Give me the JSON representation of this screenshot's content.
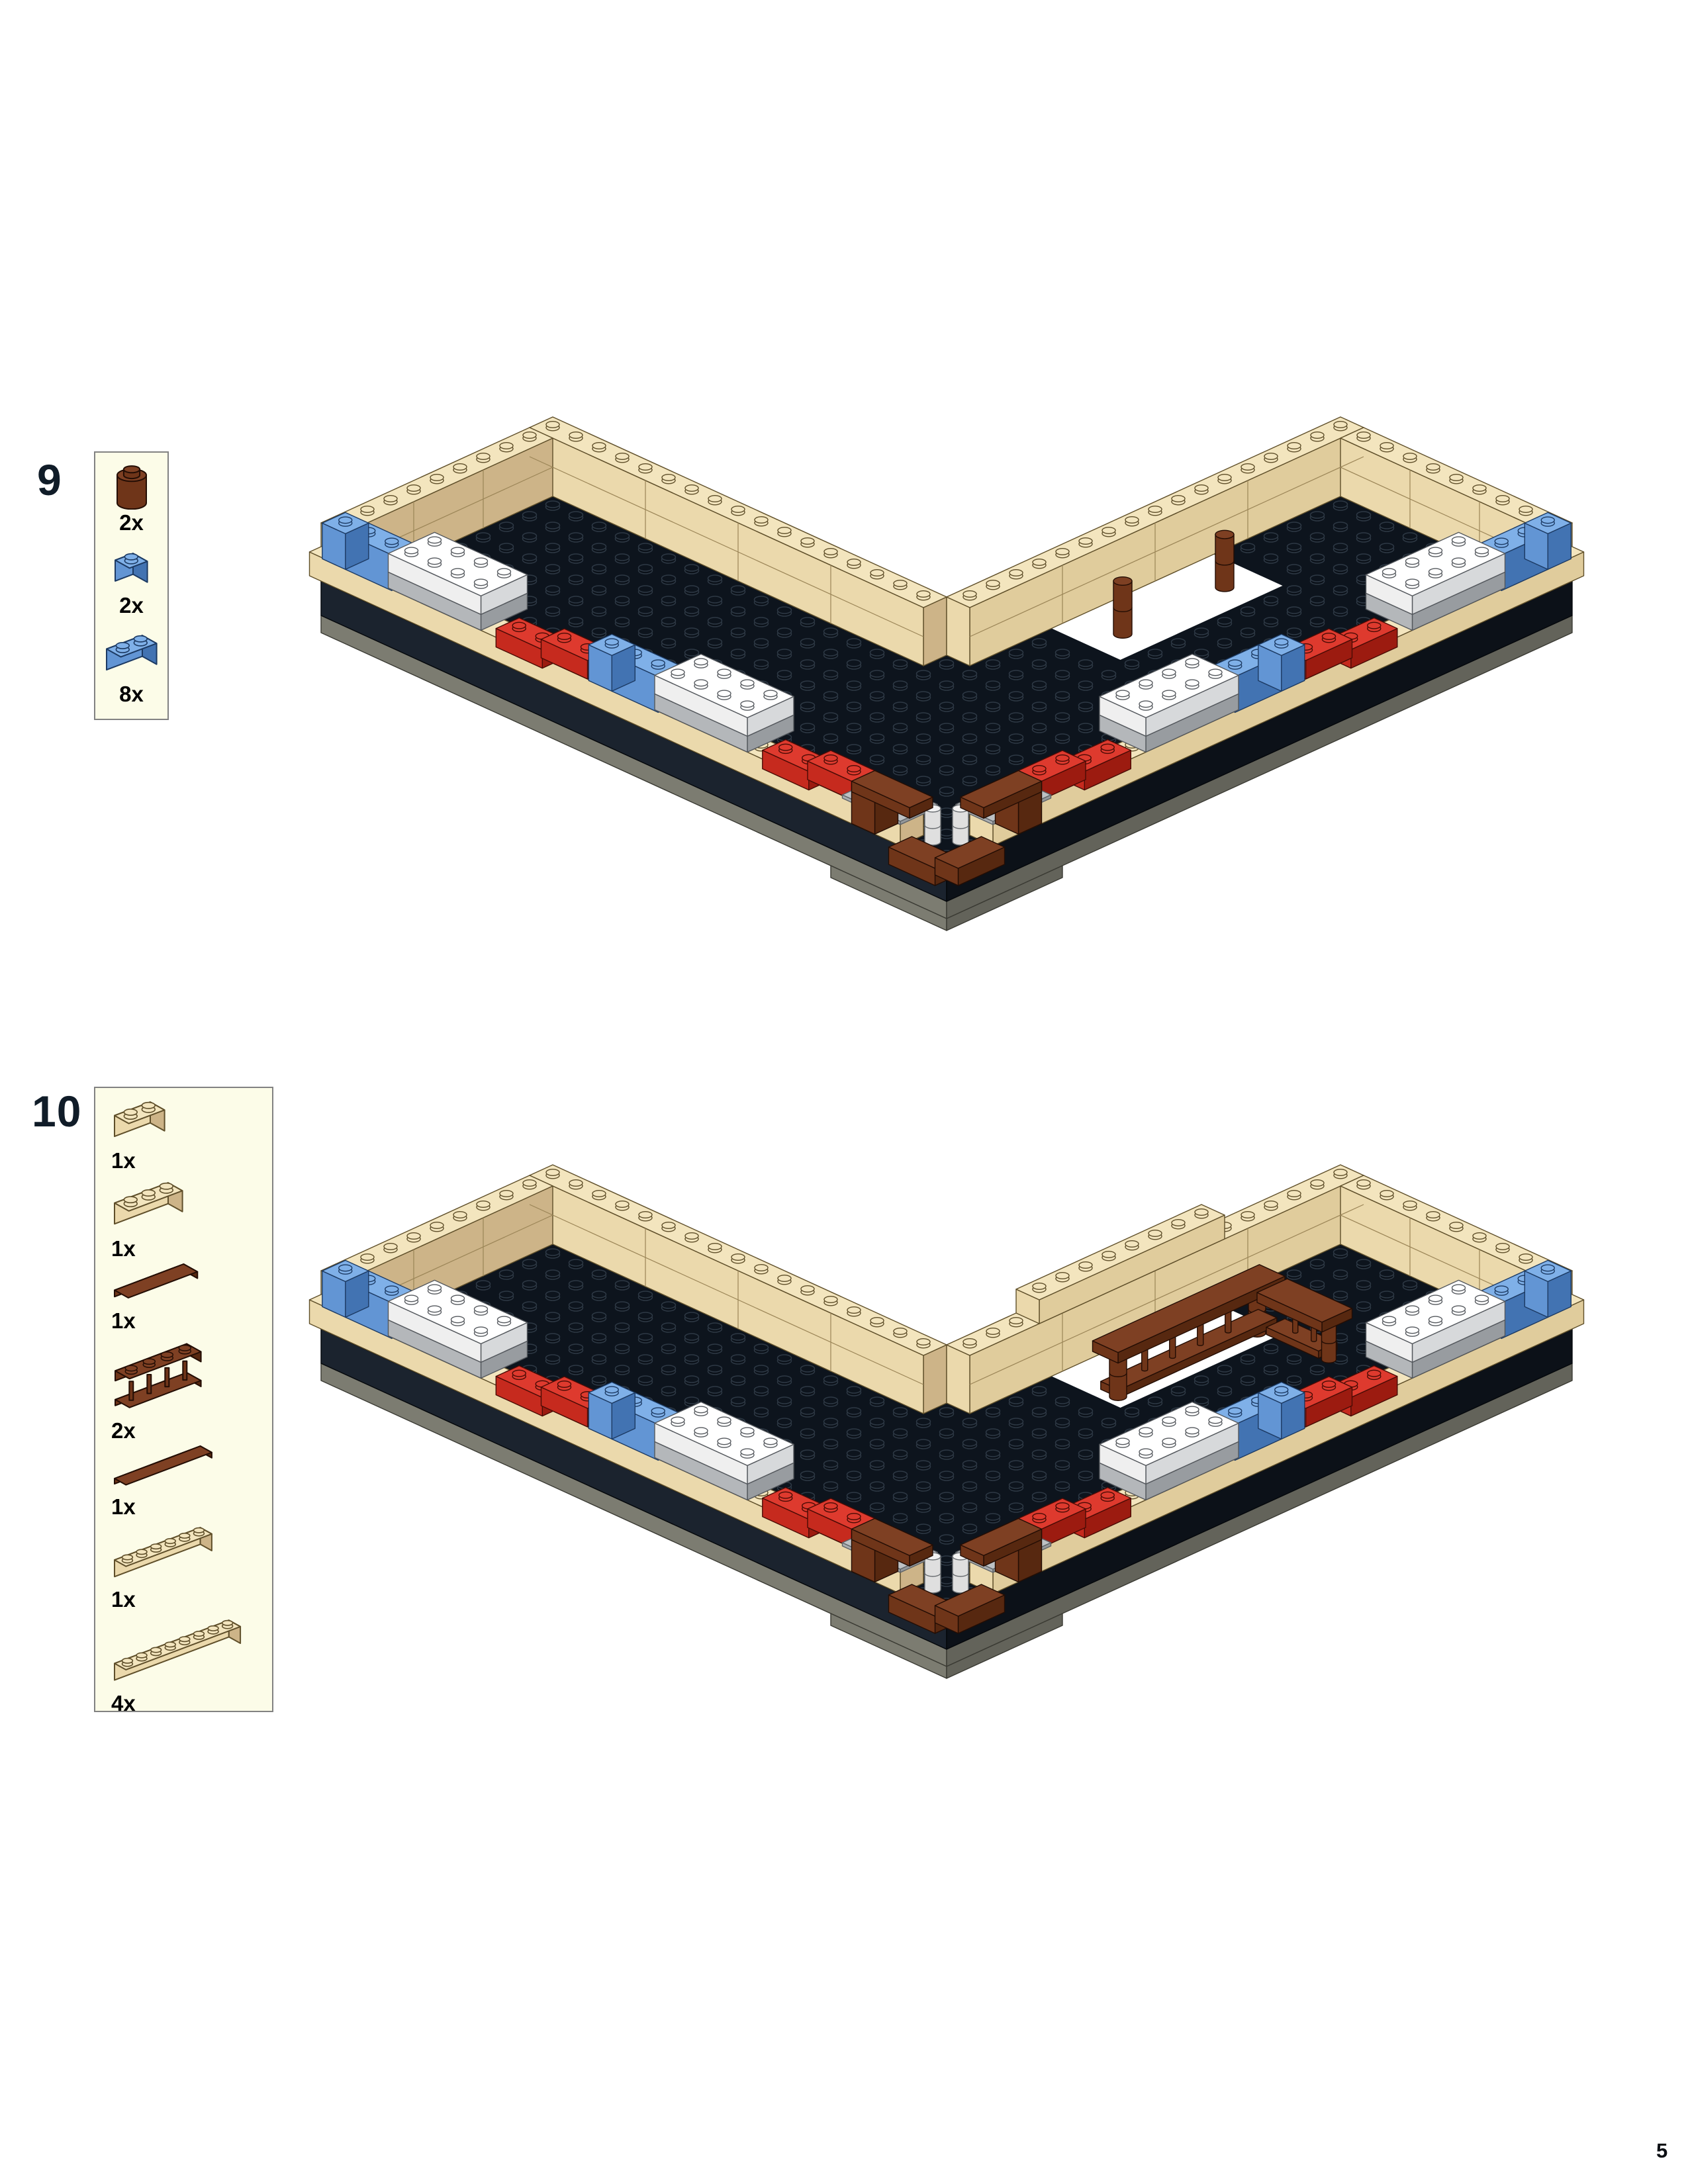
{
  "page": {
    "number": "5"
  },
  "palette": {
    "page_bg": "#ffffff",
    "callout_bg": "#fcfce8",
    "callout_border": "#828282",
    "step_number_color": "#101c28",
    "qty_color": "#000000",
    "tan": {
      "top": "#f3e5be",
      "light": "#ebd9ac",
      "dark": "#cdb488",
      "line": "#5f4f2a"
    },
    "red": {
      "top": "#de3a2e",
      "light": "#c62a1e",
      "dark": "#9c1b10",
      "line": "#4a0b05"
    },
    "blue": {
      "top": "#7fb0e8",
      "light": "#6295d4",
      "dark": "#4273b2",
      "line": "#1c3a63"
    },
    "white": {
      "top": "#ffffff",
      "light": "#efefef",
      "dark": "#d7d9db",
      "line": "#55595e"
    },
    "gray": {
      "top": "#cdd0d2",
      "light": "#b4b7ba",
      "dark": "#989ca0",
      "line": "#53575c"
    },
    "brown": {
      "top": "#7e4023",
      "light": "#6f3519",
      "dark": "#572810",
      "line": "#230d04"
    },
    "graytile": {
      "top": "#bdc1c4",
      "light": "#aaaeb1",
      "dark": "#94989b",
      "line": "#5e6266"
    },
    "whitecol": {
      "top": "#f2f2f2",
      "light": "#dfdfdf",
      "dark": "#c2c2c2",
      "line": "#6a6e72"
    },
    "floor": {
      "fill": "#0d141d",
      "stud_fill": "#0a1018",
      "stud_line": "#2e3945",
      "line": "#05080c"
    },
    "base": {
      "light": "#1b232e",
      "dark": "#0c1118",
      "line": "#04070b"
    },
    "foundation": {
      "light": "#7c7c71",
      "dark": "#63635a",
      "line": "#3a3a33"
    },
    "hole_fill": "#ffffff",
    "wall_seam": "#9b8557"
  },
  "steps": [
    {
      "number": "9",
      "parts": [
        {
          "name": "brown-1x1-round-brick",
          "qty": "2x",
          "type": "round",
          "color": "brown",
          "length": 1
        },
        {
          "name": "blue-1x1-brick",
          "qty": "2x",
          "type": "brick",
          "color": "blue",
          "length": 1
        },
        {
          "name": "blue-1x2-brick",
          "qty": "8x",
          "type": "brick",
          "color": "blue",
          "length": 2
        }
      ],
      "model": {
        "name": "step-9-assembly",
        "balcony": false,
        "columns": true
      }
    },
    {
      "number": "10",
      "parts": [
        {
          "name": "tan-1x2-brick",
          "qty": "1x",
          "type": "brick",
          "color": "tan",
          "length": 2
        },
        {
          "name": "tan-1x3-brick",
          "qty": "1x",
          "type": "brick",
          "color": "tan",
          "length": 3
        },
        {
          "name": "brown-1x4-tile",
          "qty": "1x",
          "type": "tile",
          "color": "brown",
          "length": 4
        },
        {
          "name": "brown-1x4-fence",
          "qty": "2x",
          "type": "fence",
          "color": "brown",
          "length": 4
        },
        {
          "name": "brown-1x6-tile",
          "qty": "1x",
          "type": "tile",
          "color": "brown",
          "length": 6
        },
        {
          "name": "tan-1x6-brick",
          "qty": "1x",
          "type": "brick",
          "color": "tan",
          "length": 6
        },
        {
          "name": "tan-1x8-brick",
          "qty": "4x",
          "type": "brick",
          "color": "tan",
          "length": 8
        }
      ],
      "model": {
        "name": "step-10-assembly",
        "balcony": true,
        "columns": true
      }
    }
  ]
}
